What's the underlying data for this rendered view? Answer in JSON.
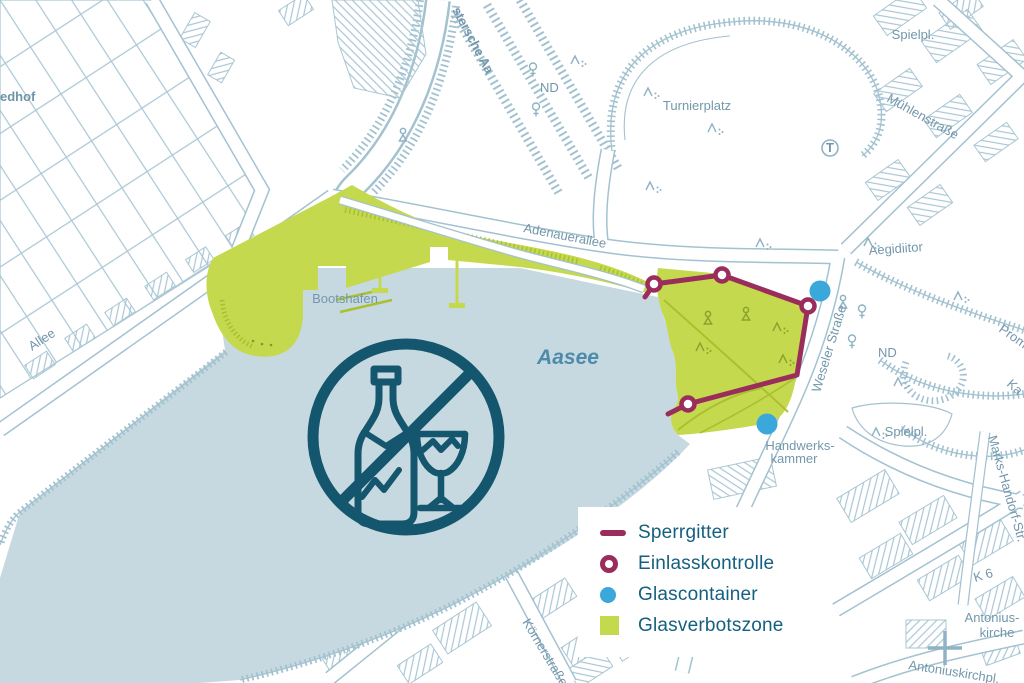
{
  "legend": {
    "items": [
      {
        "label": "Sperrgitter",
        "marker": "line",
        "color": "#9b2d5c"
      },
      {
        "label": "Einlasskontrolle",
        "marker": "ring",
        "color": "#9b2d5c"
      },
      {
        "label": "Glascontainer",
        "marker": "dot",
        "color": "#3aa8da"
      },
      {
        "label": "Glasverbotszone",
        "marker": "square",
        "color": "#c5d94e"
      }
    ]
  },
  "map": {
    "labels": {
      "friedhof": "edhof",
      "turnierplatz": "Turnierplatz",
      "aa_river": "stersche Aa",
      "nd_top": "ND",
      "adenauerallee": "Adenauerallee",
      "bootshafen": "Bootshafen",
      "aasee": "Aasee",
      "aegidiitor": "Aegidiitor",
      "spielplatz_nord": "Spielpl.",
      "muehlenstrasse": "Mühlenstraße",
      "t_stop": "T",
      "weseler_strasse": "Weseler Straße",
      "nd": "ND",
      "promenade": "Prom",
      "ka": "Ka",
      "spielplatz_ost": "Spielpl.",
      "handwerkskammer_1": "Handwerks-",
      "handwerkskammer_2": "kammer",
      "k6": "K 6",
      "antoniuskirche_1": "Antonius-",
      "antoniuskirche_2": "kirche",
      "antoniuskirchplatz": "Antoniuskirchpl.",
      "allee": "Allee",
      "koernerstrasse": "Körnerstraße",
      "marks_handorf": "Marks-Handorf-Str."
    },
    "colors": {
      "sperrgitter": "#9b2d5c",
      "glascontainer": "#3aa8da",
      "glasverbotszone": "#c5d94e",
      "glasverbotszone_dark": "#a9c02f",
      "lake": "#c7d9e0",
      "linework": "#aac7d4",
      "road_edge": "#a3c2d0",
      "map_label": "#7397ab",
      "aasee_label": "#4e8bab",
      "prohibition_icon": "#15566f",
      "legend_text": "#156080"
    },
    "sperrgitter": [
      [
        645,
        297
      ],
      [
        654,
        284
      ],
      [
        722,
        275
      ],
      [
        808,
        306
      ],
      [
        797,
        375
      ],
      [
        688,
        404
      ],
      [
        668,
        414
      ]
    ],
    "einlasskontrolle": [
      [
        654,
        284
      ],
      [
        722,
        275
      ],
      [
        808,
        306
      ],
      [
        688,
        404
      ]
    ],
    "glascontainer": [
      [
        820,
        291
      ],
      [
        767,
        424
      ]
    ]
  }
}
